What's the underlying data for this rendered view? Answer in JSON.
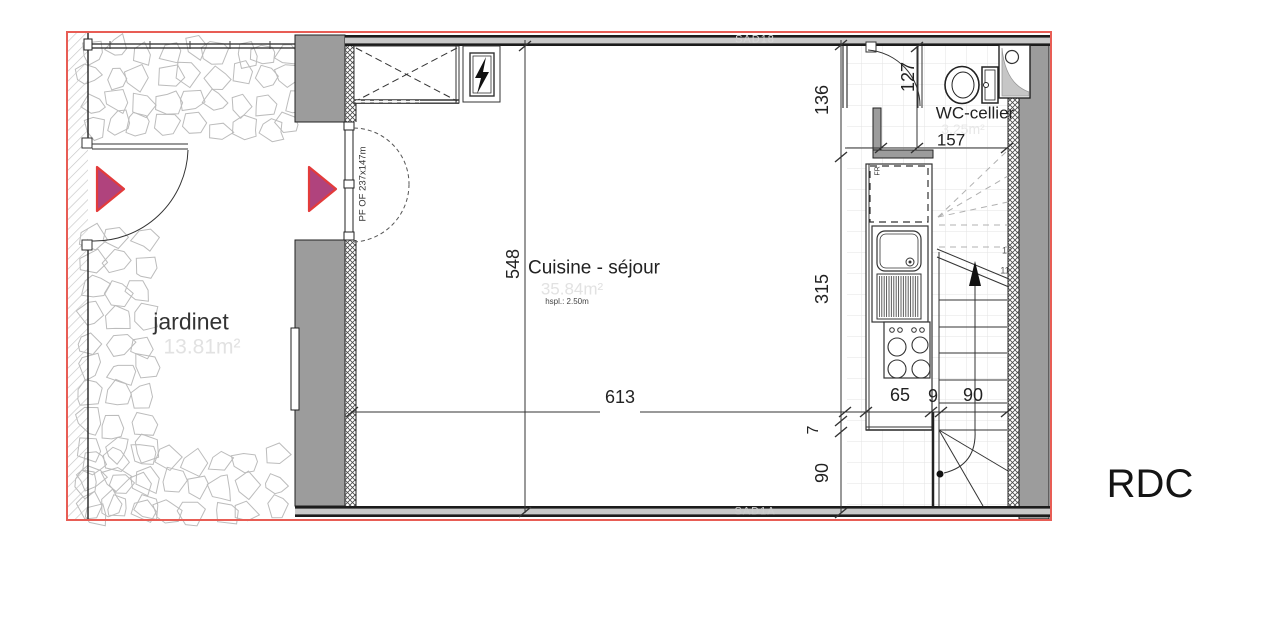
{
  "title": {
    "floor": "RDC"
  },
  "rooms": {
    "jardinet": {
      "name": "jardinet",
      "area": "13.81m²"
    },
    "cuisine": {
      "name": "Cuisine - séjour",
      "area": "35.84m²",
      "ceiling": "hspl.: 2.50m"
    },
    "wc": {
      "name": "WC-cellier",
      "area": "3.25m²"
    }
  },
  "dims": {
    "room_height": "548",
    "room_width": "613",
    "chain_136": "136",
    "chain_315": "315",
    "chain_7": "7",
    "chain_90": "90",
    "wc_height": "127",
    "wc_width": "157",
    "kitchen_65": "65",
    "wall_9": "9",
    "stair_90": "90"
  },
  "annotations": {
    "door_spec": "PF OF 237x147m",
    "fridge": "FR",
    "beam_top": "SAD18",
    "beam_bottom": "SAD1A",
    "step_upper": "12",
    "step_lower": "11"
  },
  "colors": {
    "plan_border": "#e85d55",
    "entry_arrow_fill": "#b0437d",
    "entry_arrow_stroke": "#e33b3b",
    "wall_gray": "#9c9c9c"
  }
}
